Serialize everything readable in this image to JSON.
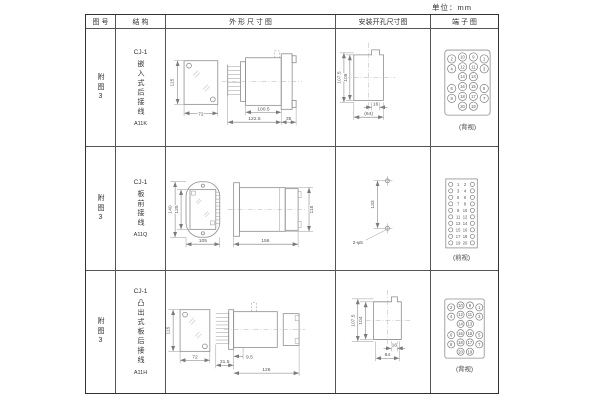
{
  "unit_label": "单位：mm",
  "header": {
    "figure": "图 号",
    "structure": "结 构",
    "outline": "外 形 尺 寸 图",
    "mounting": "安装开孔尺寸图",
    "terminal": "端 子 图"
  },
  "rows": [
    {
      "figure": "附图3",
      "structure": {
        "model": "CJ-1",
        "desc": "嵌入式后接线",
        "code": "A11K"
      },
      "outline": {
        "height": "115",
        "width": "72",
        "body_len": "100.5",
        "total_len": "122.5",
        "front_len": "35"
      },
      "mounting": {
        "outer_h": "107.5",
        "inner_h": "105",
        "notch_w": "16",
        "hole_w": "(64)"
      },
      "terminal": {
        "type": "grid",
        "view": "(背视)",
        "grid": [
          [
            "2",
            "10",
            "9",
            "1"
          ],
          [
            "4",
            "12",
            "11",
            "3"
          ],
          [
            "",
            "14",
            "13",
            ""
          ],
          [
            "6",
            "16",
            "15",
            "5"
          ],
          [
            "8",
            "18",
            "17",
            "7"
          ],
          [
            "",
            "20",
            "19",
            ""
          ]
        ]
      }
    },
    {
      "figure": "附图3",
      "structure": {
        "model": "CJ-1",
        "desc": "板前接线",
        "code": "A11Q"
      },
      "outline": {
        "outer_h": "140",
        "inner_h": "125",
        "width": "105",
        "side_len": "156",
        "side_h": "115"
      },
      "mounting": {
        "hole_dist": "133",
        "hole_label": "2-φ5"
      },
      "terminal": {
        "type": "strip",
        "view": "(前视)",
        "grid": [
          [
            "1",
            "2"
          ],
          [
            "3",
            "4"
          ],
          [
            "5",
            "6"
          ],
          [
            "7",
            "8"
          ],
          [
            "9",
            "10"
          ],
          [
            "11",
            "12"
          ],
          [
            "13",
            "14"
          ],
          [
            "15",
            "16"
          ],
          [
            "17",
            "18"
          ],
          [
            "19",
            "20"
          ]
        ]
      }
    },
    {
      "figure": "附图3",
      "structure": {
        "model": "CJ-1",
        "desc": "凸出式板后接线",
        "code": "A11H"
      },
      "outline": {
        "height": "115",
        "width": "72",
        "step_len": "9.5",
        "terminal_len": "31.5",
        "body_len": "126"
      },
      "mounting": {
        "outer_h": "107.5",
        "inner_h": "104",
        "notch_w": "16",
        "hole_w": "64"
      },
      "terminal": {
        "type": "grid",
        "view": "(背视)",
        "grid": [
          [
            "2",
            "10",
            "9",
            "1"
          ],
          [
            "4",
            "12",
            "11",
            "3"
          ],
          [
            "",
            "14",
            "13",
            ""
          ],
          [
            "6",
            "16",
            "15",
            "5"
          ],
          [
            "8",
            "18",
            "17",
            "7"
          ],
          [
            "",
            "20",
            "19",
            ""
          ]
        ]
      }
    }
  ]
}
